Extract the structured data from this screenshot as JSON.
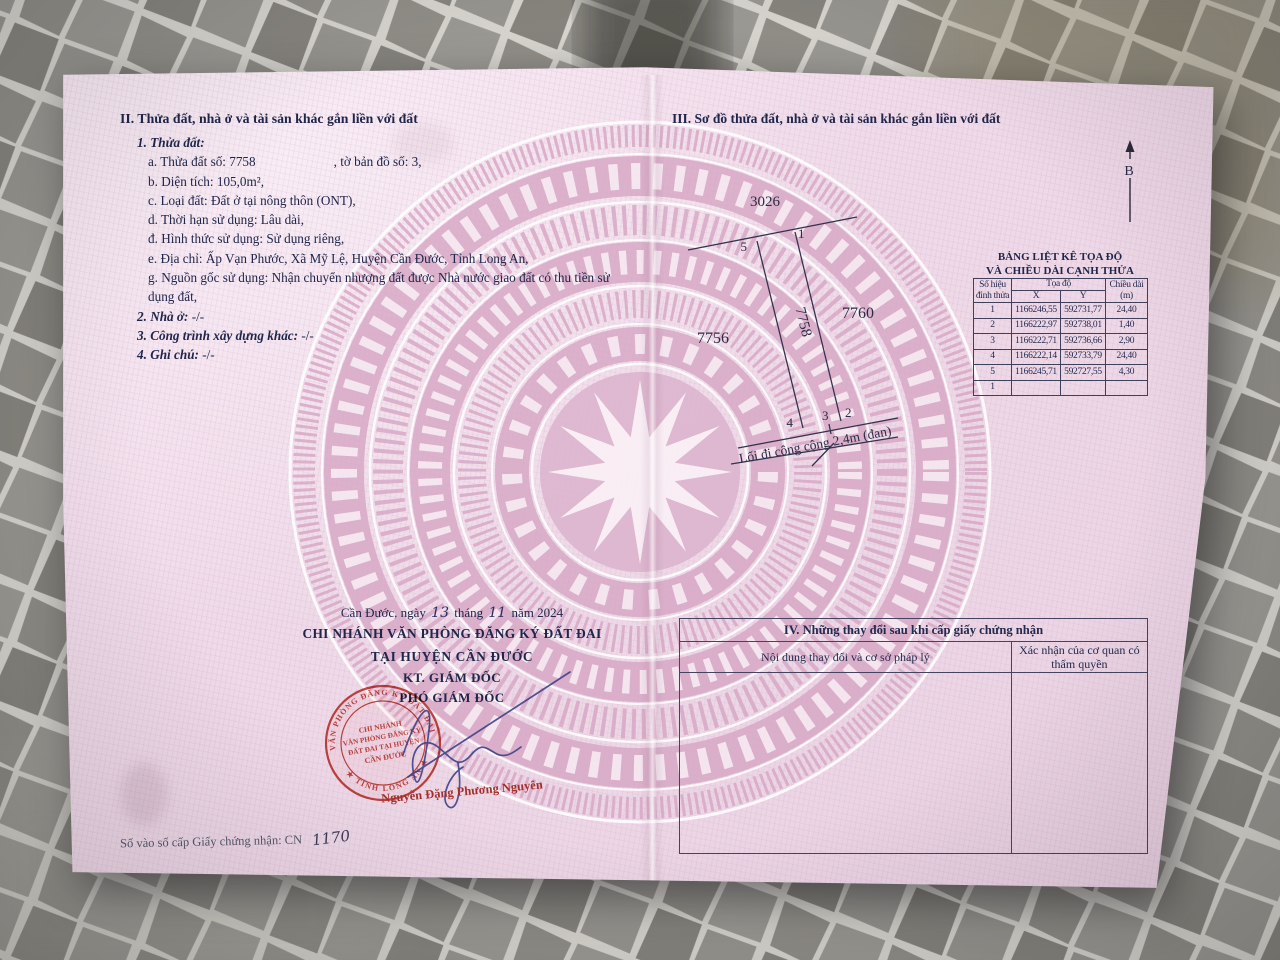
{
  "page": {
    "section2": {
      "heading": "II. Thửa đất, nhà ở và tài sản khác gắn liền với đất",
      "item1": "1. Thửa đất:",
      "a1": "a. Thửa đất số: 7758",
      "a2": ", tờ bản đồ số: 3,",
      "b": "b. Diện tích: 105,0m²,",
      "c": "c. Loại đất: Đất ở tại nông thôn (ONT),",
      "d": "d. Thời hạn sử dụng: Lâu dài,",
      "dd": "đ. Hình thức sử dụng: Sử dụng riêng,",
      "e": "e. Địa chỉ: Ấp Vạn Phước, Xã Mỹ Lệ, Huyện Cần Đước, Tỉnh Long An,",
      "g1": "g. Nguồn gốc sử dụng: Nhận chuyển nhượng đất được Nhà nước giao đất có thu tiền sử",
      "g2": "dụng đất,",
      "item2_label": "2. Nhà ở:",
      "item2_value": "-/-",
      "item3_label": "3. Công trình xây dựng khác:",
      "item3_value": "-/-",
      "item4_label": "4. Ghi chú:",
      "item4_value": "-/-"
    },
    "section3": {
      "heading": "III. Sơ đồ thửa đất, nhà ở và tài sản khác gắn liền với đất",
      "north_label": "B"
    },
    "diagram": {
      "parcel_top": "3026",
      "parcel_left": "7756",
      "parcel_center": "7758",
      "parcel_right": "7760",
      "v1": "1",
      "v2": "2",
      "v3": "3",
      "v4": "4",
      "v5": "5",
      "road_label": "Lối đi công cộng 2,4m (đan)"
    },
    "coord_table": {
      "title1": "BẢNG LIỆT KÊ TỌA ĐỘ",
      "title2": "VÀ CHIỀU DÀI CẠNH THỬA",
      "col_vertex": "Số hiệu đỉnh thửa",
      "col_coord": "Tọa độ",
      "col_x": "X",
      "col_y": "Y",
      "col_len": "Chiều dài (m)",
      "rows": [
        [
          "1",
          "1166246,55",
          "592731,77",
          "24,40"
        ],
        [
          "2",
          "1166222,97",
          "592738,01",
          "1,40"
        ],
        [
          "3",
          "1166222,71",
          "592736,66",
          "2,90"
        ],
        [
          "4",
          "1166222,14",
          "592733,79",
          "24,40"
        ],
        [
          "5",
          "1166245,71",
          "592727,55",
          "4,30"
        ],
        [
          "1",
          "",
          "",
          ""
        ]
      ]
    },
    "section4": {
      "heading": "IV. Những thay đổi sau khi cấp giấy chứng nhận",
      "col_content": "Nội dung thay đổi và cơ sở pháp lý",
      "col_confirm": "Xác nhận của cơ quan có thẩm quyền"
    },
    "signing": {
      "date_prefix": "Cần Đước, ngày",
      "date_day": "13",
      "date_mid": "tháng",
      "date_month": "11",
      "date_suffix": "năm 2024",
      "office_line1": "CHI NHÁNH VĂN PHÒNG ĐĂNG KÝ ĐẤT ĐAI",
      "office_line2": "TẠI HUYỆN CẦN ĐƯỚC",
      "role_line1": "KT. GIÁM ĐỐC",
      "role_line2": "PHÓ GIÁM ĐỐC",
      "signer_name": "Nguyễn Đặng Phương Nguyên"
    },
    "stamp": {
      "rim_top": "VĂN PHÒNG ĐĂNG KÝ ĐẤT ĐAI",
      "rim_bottom": "★ TỈNH LONG AN ★",
      "line1": "CHI NHÁNH",
      "line2": "VĂN PHÒNG ĐĂNG KÝ",
      "line3": "ĐẤT ĐAI TẠI HUYỆN",
      "line4": "CẦN ĐƯỚC"
    },
    "footer": {
      "label": "Số vào sổ cấp Giấy chứng nhận: CN",
      "number": "1170"
    }
  },
  "colors": {
    "stamp_red": "#c23b33",
    "name_red": "#a3302c",
    "ink_blue": "#3b3e85",
    "text_navy": "#20264a",
    "paper_pink": "#f0dcea",
    "pattern_pink": "#d8a9c6",
    "tile_grey": "#8f8d86"
  }
}
